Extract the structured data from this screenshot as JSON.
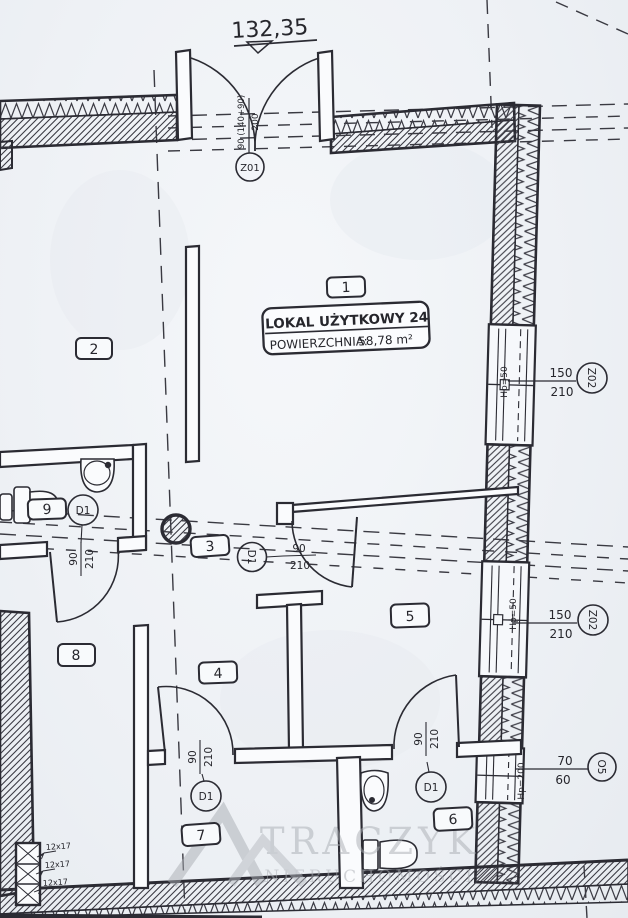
{
  "plan": {
    "total_dimension": "132,35",
    "unit_box": {
      "title": "LOKAL UŻYTKOWY 24",
      "area_label": "POWIERZCHNIA:",
      "area_value": "58,78 m²"
    },
    "rooms": {
      "r1": "1",
      "r2": "2",
      "r3": "3",
      "r4": "4",
      "r5": "5",
      "r6": "6",
      "r7": "7",
      "r8": "8",
      "r9": "9"
    },
    "entrance": {
      "code": "Z01",
      "dim_top": "90 (140+90)",
      "dim_bottom": "200"
    },
    "door": {
      "code": "D1",
      "width": "90",
      "height": "210"
    },
    "windows": [
      {
        "code": "Z02",
        "width": "150",
        "height": "210",
        "sill": "Hp=50"
      },
      {
        "code": "Z02",
        "width": "150",
        "height": "210",
        "sill": "Hp=50"
      },
      {
        "code": "O5",
        "width": "70",
        "height": "60",
        "sill": "Hp=200"
      }
    ],
    "duct_labels": [
      "12x17",
      "12x17",
      "12x17"
    ],
    "watermark": {
      "brand": "TRACZYK",
      "subtitle": "NIERUCHOMOŚCI"
    }
  }
}
